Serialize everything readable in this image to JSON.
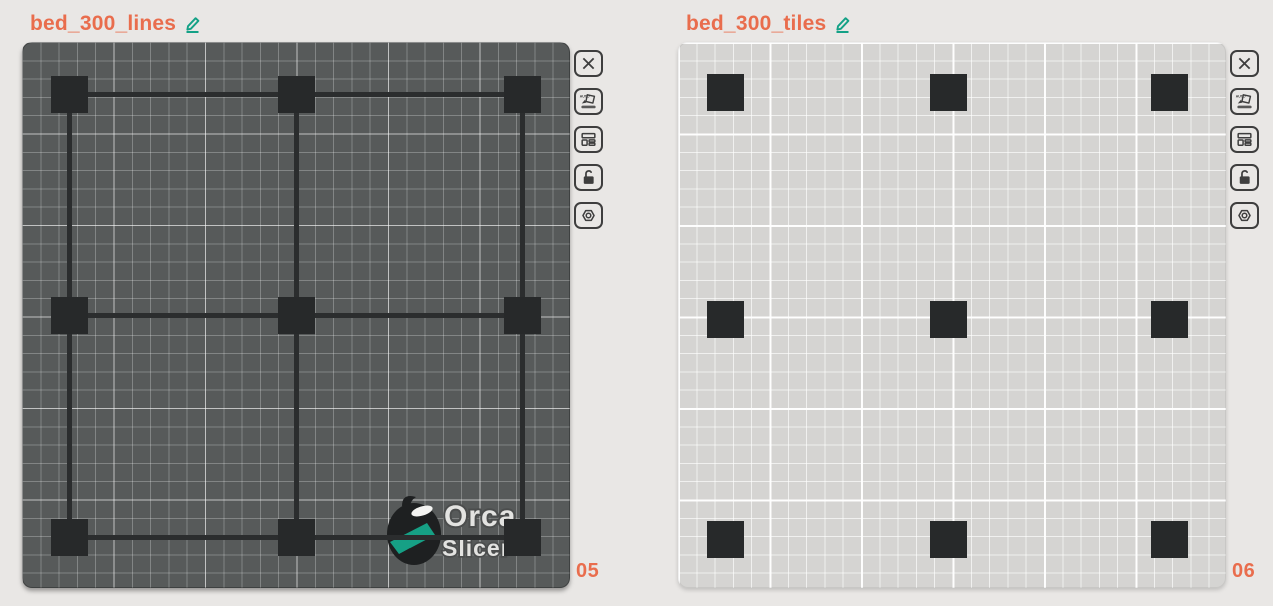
{
  "page": {
    "background": "#e9e7e5"
  },
  "accent": {
    "orange": "#e96d4d",
    "teal": "#14a186",
    "square_color": "#27292a"
  },
  "plates": [
    {
      "name": "bed_300_lines",
      "number": "05",
      "bed_style": "dark",
      "has_connecting_lines": true,
      "has_logo": true,
      "layout": {
        "col_centers": [
          47,
          274,
          500
        ],
        "row_centers": [
          52,
          273,
          495
        ],
        "square_size": 37,
        "line_thickness": 5
      }
    },
    {
      "name": "bed_300_tiles",
      "number": "06",
      "bed_style": "light",
      "has_connecting_lines": false,
      "has_logo": false,
      "layout": {
        "col_centers": [
          47,
          270,
          491
        ],
        "row_centers": [
          50,
          277,
          497
        ],
        "square_size": 37,
        "line_thickness": 5
      }
    }
  ],
  "toolbar": {
    "buttons": [
      {
        "name": "delete-plate",
        "icon": "close-icon"
      },
      {
        "name": "auto-orient",
        "icon": "auto-orient-icon"
      },
      {
        "name": "arrange-plate",
        "icon": "arrange-icon"
      },
      {
        "name": "lock-plate",
        "icon": "lock-open-icon"
      },
      {
        "name": "plate-settings",
        "icon": "plate-settings-icon"
      }
    ]
  },
  "logo": {
    "line1": "Orca",
    "line2": "Slicer"
  },
  "title_edit_icon": "pencil-icon"
}
